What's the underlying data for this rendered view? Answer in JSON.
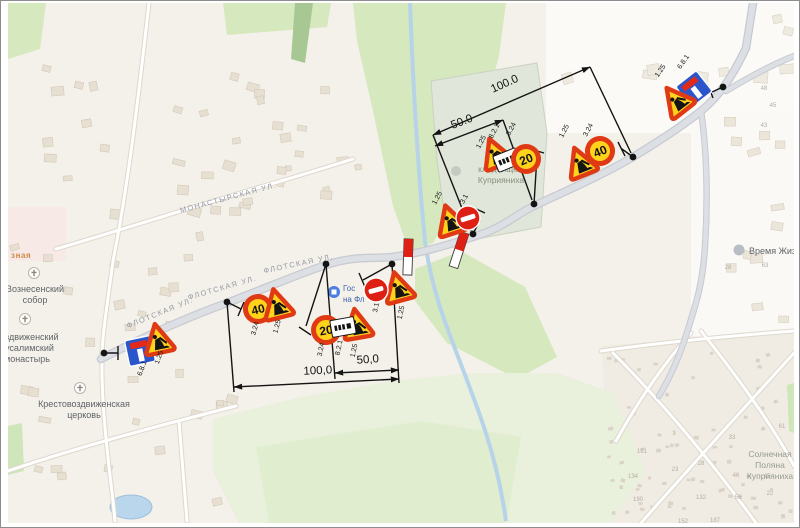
{
  "map": {
    "street_labels": [
      {
        "t": "ФЛОТСКАЯ УЛ.",
        "x": 160,
        "y": 314,
        "r": -22
      },
      {
        "t": "ФЛОТСКАЯ УЛ.",
        "x": 222,
        "y": 289,
        "r": -16
      },
      {
        "t": "ФЛОТСКАЯ УЛ.",
        "x": 298,
        "y": 265,
        "r": -12
      },
      {
        "t": "МОНАСТЫРСКАЯ УЛ.",
        "x": 228,
        "y": 199,
        "r": -15
      }
    ],
    "clipped_street_label": "зная",
    "pois": {
      "cathedral": {
        "line1": "Вознесенский",
        "line2": "собор"
      },
      "monastery": {
        "line1": "воздвиженский",
        "line2": "русалимский",
        "line3": "монастырь"
      },
      "church": {
        "line1": "Крестовоздвиженская",
        "line2": "церковь"
      },
      "cemetery": {
        "line1": "кладбище",
        "line2": "Куприяниха"
      },
      "hotel": {
        "line1": "Гос",
        "line2": "на Фл"
      },
      "vremya": {
        "line1": "Время Жиз"
      },
      "solnechnaya": {
        "line1": "Солнечная",
        "line2": "Поляна",
        "line3": "Куприяниха"
      }
    },
    "house_numbers": [
      {
        "t": "48",
        "x": 763,
        "y": 89
      },
      {
        "t": "45",
        "x": 772,
        "y": 106
      },
      {
        "t": "43",
        "x": 763,
        "y": 126
      },
      {
        "t": "28",
        "x": 727,
        "y": 268
      },
      {
        "t": "63",
        "x": 764,
        "y": 266
      },
      {
        "t": "61",
        "x": 781,
        "y": 427
      },
      {
        "t": "3",
        "x": 673,
        "y": 434
      },
      {
        "t": "33",
        "x": 731,
        "y": 438
      },
      {
        "t": "161",
        "x": 641,
        "y": 452
      },
      {
        "t": "28",
        "x": 700,
        "y": 464
      },
      {
        "t": "23",
        "x": 674,
        "y": 470
      },
      {
        "t": "46",
        "x": 735,
        "y": 476
      },
      {
        "t": "134",
        "x": 632,
        "y": 477
      },
      {
        "t": "45",
        "x": 766,
        "y": 477
      },
      {
        "t": "190",
        "x": 637,
        "y": 500
      },
      {
        "t": "132",
        "x": 700,
        "y": 498
      },
      {
        "t": "56",
        "x": 737,
        "y": 498
      },
      {
        "t": "22",
        "x": 769,
        "y": 494
      },
      {
        "t": "152",
        "x": 682,
        "y": 522
      },
      {
        "t": "187",
        "x": 714,
        "y": 521
      }
    ]
  },
  "scheme": {
    "dimensions": {
      "top_100": "100.0",
      "top_50": "50.0",
      "bottom_100": "100,0",
      "bottom_50": "50,0"
    },
    "sign_values": {
      "speed40": "40",
      "speed20": "20"
    },
    "sign_labels": [
      {
        "t": "1.25",
        "x": 661,
        "y": 71,
        "r": -55
      },
      {
        "t": "6.8.1",
        "x": 684,
        "y": 62,
        "r": -55
      },
      {
        "t": "1.25",
        "x": 565,
        "y": 131,
        "r": -62
      },
      {
        "t": "3.24",
        "x": 589,
        "y": 130,
        "r": -62
      },
      {
        "t": "1.25",
        "x": 482,
        "y": 142,
        "r": -62
      },
      {
        "t": "8.2.1",
        "x": 495,
        "y": 131,
        "r": -62
      },
      {
        "t": "3.24",
        "x": 512,
        "y": 129,
        "r": -62
      },
      {
        "t": "1.25",
        "x": 438,
        "y": 198,
        "r": -62
      },
      {
        "t": "3.1",
        "x": 465,
        "y": 199,
        "r": -62
      },
      {
        "t": "3.1",
        "x": 377,
        "y": 307,
        "r": -78
      },
      {
        "t": "1.25",
        "x": 402,
        "y": 312,
        "r": -78
      },
      {
        "t": "3.24",
        "x": 322,
        "y": 349,
        "r": -78
      },
      {
        "t": "8.2.1",
        "x": 340,
        "y": 347,
        "r": -78
      },
      {
        "t": "1.25",
        "x": 355,
        "y": 350,
        "r": -78
      },
      {
        "t": "3.24",
        "x": 256,
        "y": 328,
        "r": -75
      },
      {
        "t": "1.25",
        "x": 278,
        "y": 326,
        "r": -75
      },
      {
        "t": "1.25",
        "x": 160,
        "y": 357,
        "r": -70
      },
      {
        "t": "6.8.1",
        "x": 143,
        "y": 368,
        "r": -70
      }
    ],
    "colors": {
      "sign_yellow": "#ffd21c",
      "sign_red": "#e03a14",
      "no_entry_red": "#dd2013",
      "dead_end_blue": "#2b55cb",
      "annotation": "#141414"
    }
  }
}
